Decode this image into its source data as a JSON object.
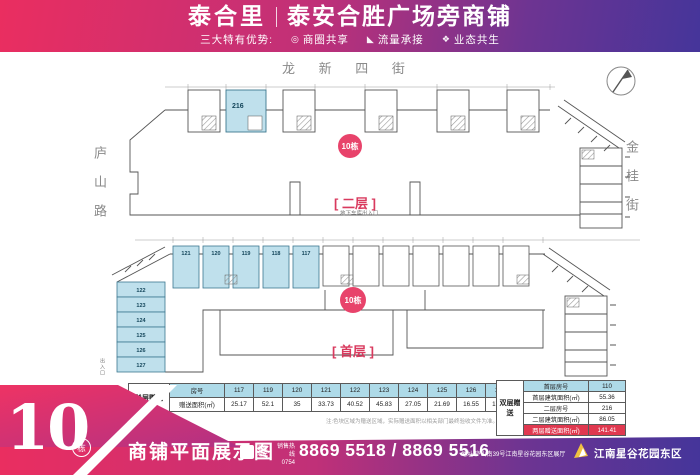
{
  "header": {
    "brand": "泰合里",
    "title": "泰安合胜广场旁商铺",
    "advantages_label": "三大特有优势:",
    "advantages": [
      {
        "icon": "share-circle-icon",
        "glyph": "◎",
        "label": "商圈共享"
      },
      {
        "icon": "flow-icon",
        "glyph": "◣",
        "label": "流量承接"
      },
      {
        "icon": "eco-icon",
        "glyph": "❖",
        "label": "业态共生"
      }
    ]
  },
  "streets": {
    "top": "龙 新 四 街",
    "left": "庐山路",
    "right": "金桂街"
  },
  "plans": {
    "upper": {
      "floor_label": "[ 二层 ]",
      "badge": "10栋",
      "highlight_unit": "216",
      "note": "地下车库出入口"
    },
    "lower": {
      "floor_label": "[ 首层 ]",
      "badge": "10栋",
      "top_units": [
        "121",
        "120",
        "119",
        "118",
        "117"
      ],
      "left_units": [
        "122",
        "123",
        "124",
        "125",
        "126",
        "127"
      ],
      "entrance_left": "出入口",
      "entrance_right": "人行出入口"
    }
  },
  "tables": {
    "single": {
      "row_label": "单层赠送",
      "col_header": "房号",
      "area_header": "赠送面积(㎡)",
      "units": [
        "117",
        "119",
        "120",
        "121",
        "122",
        "123",
        "124",
        "125",
        "126",
        "127"
      ],
      "areas": [
        "25.17",
        "52.1",
        "35",
        "33.73",
        "40.52",
        "45.83",
        "27.05",
        "21.69",
        "16.55",
        "17.21"
      ]
    },
    "double": {
      "row_label": "双层赠送",
      "rows": [
        {
          "name": "首层房号",
          "value": "110"
        },
        {
          "name": "首层建筑面积(㎡)",
          "value": "55.36"
        },
        {
          "name": "二层房号",
          "value": "216"
        },
        {
          "name": "二层建筑面积(㎡)",
          "value": "86.05"
        },
        {
          "name": "两层赠送面积(㎡)",
          "value": "141.41"
        }
      ]
    },
    "disclaimer": "注:色块区域为赠送区域，实际赠送面积以相关部门最终验收文件为准。"
  },
  "footer": {
    "big_number": "10",
    "unit_word": "栋",
    "title": "商铺平面展示图",
    "logo_char": "泰",
    "logo_name": "泰业地产",
    "hotline_label": "销售热线",
    "area_code": "0754",
    "phone": "8869 5518 / 8869 5516",
    "address": "地址:庐山南39号江南星谷花园东区展厅",
    "project": "江南星谷花园东区"
  },
  "colors": {
    "accent": "#d93a5e",
    "unit_fill": "#bfe0ec",
    "table_header": "#aedae8",
    "red_row": "#e0384f"
  }
}
